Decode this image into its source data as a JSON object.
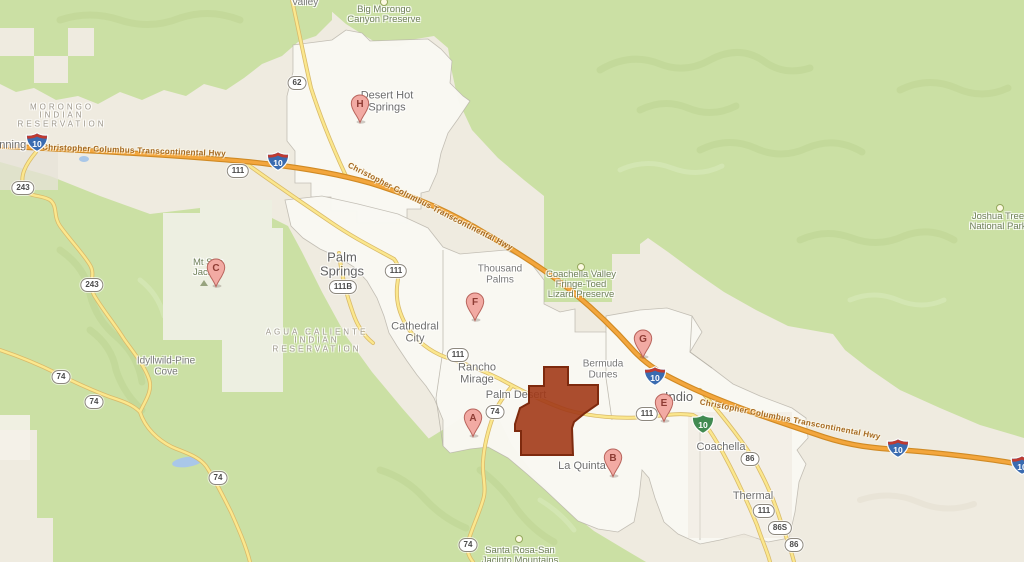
{
  "map": {
    "region": {
      "id": "selected-area",
      "points": "544,367 568,367 568,385 598,385 598,404 585,413 574,422 572,428 573,455 521,455 521,431 515,431 515,424 520,408 529,403 529,386 544,386",
      "fill": "#a23a18",
      "fill_opacity": 0.9,
      "stroke": "#7e2a0e"
    },
    "markers": [
      {
        "letter": "A",
        "x": 473,
        "y": 417
      },
      {
        "letter": "B",
        "x": 613,
        "y": 457
      },
      {
        "letter": "C",
        "x": 216,
        "y": 267
      },
      {
        "letter": "E",
        "x": 664,
        "y": 402
      },
      {
        "letter": "F",
        "x": 475,
        "y": 301
      },
      {
        "letter": "G",
        "x": 643,
        "y": 338
      },
      {
        "letter": "H",
        "x": 360,
        "y": 103
      }
    ],
    "shields": [
      {
        "type": "interstate",
        "label": "10",
        "x": 37,
        "y": 142
      },
      {
        "type": "interstate",
        "label": "10",
        "x": 278,
        "y": 161
      },
      {
        "type": "interstate",
        "label": "10",
        "x": 655,
        "y": 376
      },
      {
        "type": "interstate",
        "label": "10",
        "x": 898,
        "y": 448
      },
      {
        "type": "interstate",
        "label": "10",
        "x": 1022,
        "y": 465
      },
      {
        "type": "business",
        "label": "10",
        "x": 703,
        "y": 424
      },
      {
        "type": "state",
        "label": "62",
        "x": 297,
        "y": 83
      },
      {
        "type": "state",
        "label": "111",
        "x": 238,
        "y": 171
      },
      {
        "type": "state",
        "label": "111",
        "x": 396,
        "y": 271
      },
      {
        "type": "state",
        "label": "111B",
        "x": 343,
        "y": 287
      },
      {
        "type": "state",
        "label": "111",
        "x": 458,
        "y": 355
      },
      {
        "type": "state",
        "label": "111",
        "x": 647,
        "y": 414
      },
      {
        "type": "state",
        "label": "111",
        "x": 764,
        "y": 511
      },
      {
        "type": "state",
        "label": "243",
        "x": 23,
        "y": 188
      },
      {
        "type": "state",
        "label": "243",
        "x": 92,
        "y": 285
      },
      {
        "type": "state",
        "label": "74",
        "x": 61,
        "y": 377
      },
      {
        "type": "state",
        "label": "74",
        "x": 94,
        "y": 402
      },
      {
        "type": "state",
        "label": "74",
        "x": 218,
        "y": 478
      },
      {
        "type": "state",
        "label": "74",
        "x": 495,
        "y": 412
      },
      {
        "type": "state",
        "label": "74",
        "x": 468,
        "y": 545
      },
      {
        "type": "state",
        "label": "86",
        "x": 750,
        "y": 459
      },
      {
        "type": "state",
        "label": "86S",
        "x": 780,
        "y": 528
      },
      {
        "type": "state",
        "label": "86",
        "x": 794,
        "y": 545
      }
    ],
    "labels": [
      {
        "id": "morongo-valley",
        "lines": [
          "Valley"
        ],
        "x": 305,
        "y": 3,
        "cls": "city-sm"
      },
      {
        "id": "big-morongo-canyon-preserve",
        "lines": [
          "Big Morongo",
          "Canyon Preserve"
        ],
        "x": 384,
        "y": 15,
        "cls": "park"
      },
      {
        "id": "morongo-indian-reservation",
        "lines": [
          "MORONGO",
          "INDIAN",
          "RESERVATION"
        ],
        "x": 62,
        "y": 116,
        "cls": "res"
      },
      {
        "id": "banning",
        "lines": [
          "Banning"
        ],
        "x": 6,
        "y": 146,
        "cls": "city"
      },
      {
        "id": "desert-hot-springs",
        "lines": [
          "Desert Hot",
          "Springs"
        ],
        "x": 387,
        "y": 102,
        "cls": "city"
      },
      {
        "id": "joshua-tree-national-park",
        "lines": [
          "Joshua Tree",
          "National Park"
        ],
        "x": 998,
        "y": 222,
        "cls": "park"
      },
      {
        "id": "hwy-label-west",
        "lines": [
          "Christopher Columbus Transcontinental Hwy"
        ],
        "x": 134,
        "y": 151,
        "cls": "hwy",
        "rot": 2
      },
      {
        "id": "hwy-label-mid",
        "lines": [
          "Christopher Columbus Transcontinental Hwy"
        ],
        "x": 430,
        "y": 207,
        "cls": "hwy",
        "rot": 27
      },
      {
        "id": "hwy-label-east",
        "lines": [
          "Christopher Columbus Transcontinental Hwy"
        ],
        "x": 790,
        "y": 420,
        "cls": "hwy",
        "rot": 11
      },
      {
        "id": "palm-springs",
        "lines": [
          "Palm",
          "Springs"
        ],
        "x": 342,
        "y": 264,
        "cls": "city-lg"
      },
      {
        "id": "thousand-palms",
        "lines": [
          "Thousand",
          "Palms"
        ],
        "x": 500,
        "y": 275,
        "cls": "city-sm"
      },
      {
        "id": "coachella-valley-preserve",
        "lines": [
          "Coachella Valley",
          "Fringe-Toed",
          "Lizard Preserve"
        ],
        "x": 581,
        "y": 285,
        "cls": "park"
      },
      {
        "id": "cathedral-city",
        "lines": [
          "Cathedral",
          "City"
        ],
        "x": 415,
        "y": 333,
        "cls": "city"
      },
      {
        "id": "agua-caliente-indian-reservation",
        "lines": [
          "AGUA CALIENTE",
          "INDIAN",
          "RESERVATION"
        ],
        "x": 317,
        "y": 341,
        "cls": "res"
      },
      {
        "id": "idyllwild-pine-cove",
        "lines": [
          "Idyllwild-Pine",
          "Cove"
        ],
        "x": 166,
        "y": 367,
        "cls": "city-sm"
      },
      {
        "id": "mt-san-jacinto",
        "lines": [
          "Mt San",
          "Jacinto"
        ],
        "x": 208,
        "y": 268,
        "cls": "park"
      },
      {
        "id": "rancho-mirage",
        "lines": [
          "Rancho",
          "Mirage"
        ],
        "x": 477,
        "y": 374,
        "cls": "city"
      },
      {
        "id": "palm-desert",
        "lines": [
          "Palm Desert"
        ],
        "x": 516,
        "y": 396,
        "cls": "city"
      },
      {
        "id": "bermuda-dunes",
        "lines": [
          "Bermuda",
          "Dunes"
        ],
        "x": 603,
        "y": 370,
        "cls": "city-sm"
      },
      {
        "id": "indio",
        "lines": [
          "Indio"
        ],
        "x": 679,
        "y": 397,
        "cls": "city-lg"
      },
      {
        "id": "coachella",
        "lines": [
          "Coachella"
        ],
        "x": 721,
        "y": 448,
        "cls": "city"
      },
      {
        "id": "la-quinta",
        "lines": [
          "La Quinta"
        ],
        "x": 582,
        "y": 467,
        "cls": "city"
      },
      {
        "id": "thermal",
        "lines": [
          "Thermal"
        ],
        "x": 753,
        "y": 497,
        "cls": "city"
      },
      {
        "id": "santa-rosa-san-jacinto-mountains",
        "lines": [
          "Santa Rosa-San",
          "Jacinto Mountains"
        ],
        "x": 520,
        "y": 556,
        "cls": "park"
      }
    ],
    "poi_icons": [
      {
        "kind": "park-dot",
        "x": 384,
        "y": 2
      },
      {
        "kind": "park-dot",
        "x": 581,
        "y": 267
      },
      {
        "kind": "park-dot",
        "x": 1000,
        "y": 208
      },
      {
        "kind": "park-dot",
        "x": 519,
        "y": 539
      },
      {
        "kind": "peak",
        "x": 204,
        "y": 283
      }
    ],
    "colors": {
      "background": "#efebe0",
      "park_green": "#cbe0a4",
      "state_park_pale": "#edefe1",
      "city_white": "#f9f8f3",
      "water_blue": "#a9c7e8",
      "major_road": "#f3a63d",
      "major_road_casing": "#d08a24",
      "minor_road": "#fbe78d",
      "minor_road_casing": "#d9ba6a",
      "marker_fill": "#f2aaa3",
      "marker_stroke": "#b9655d",
      "marker_letter": "#8e3c34",
      "interstate_blue": "#3a6bb0",
      "interstate_red": "#bf3a31",
      "business_green": "#418a51"
    }
  }
}
